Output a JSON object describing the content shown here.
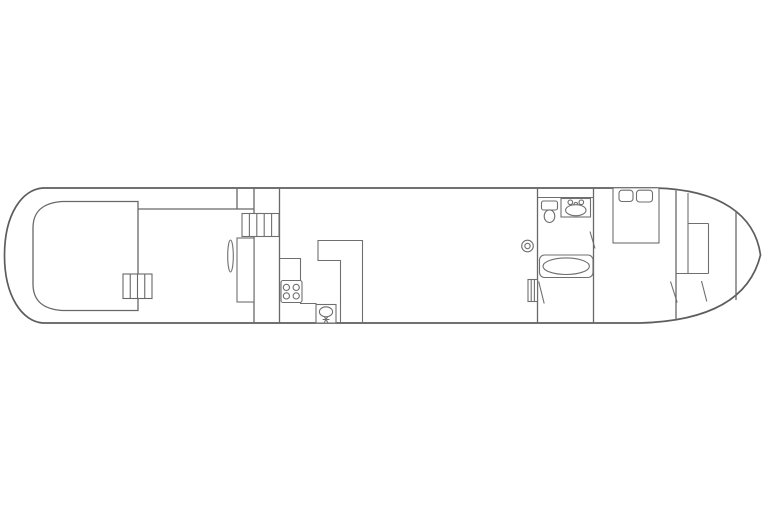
{
  "document": {
    "kind": "floor-plan",
    "subject": "boat-deck-layout-line-drawing",
    "background": "#ffffff"
  },
  "colors": {
    "hull_line": "#5d5d5d",
    "wall_line": "#686868",
    "fixture_line": "#6f6f6f",
    "fill": "#ffffff"
  },
  "fixtures": [
    "stern-deck-structure",
    "stern-deck-steps",
    "side-deck-rail",
    "cabin-door-leaf",
    "wardrobe",
    "companionway-steps",
    "galley-counter",
    "stove-four-burner",
    "galley-sink-with-drain",
    "breakfast-bar-peninsula",
    "round-ceiling-fixture",
    "toilet",
    "washbasin-with-taps",
    "bathtub",
    "deck-access-steps",
    "bathroom-door-leaf",
    "double-bed",
    "pillow",
    "pillow",
    "bow-locker",
    "bow-door-leaves",
    "forepeak-bulkhead"
  ]
}
